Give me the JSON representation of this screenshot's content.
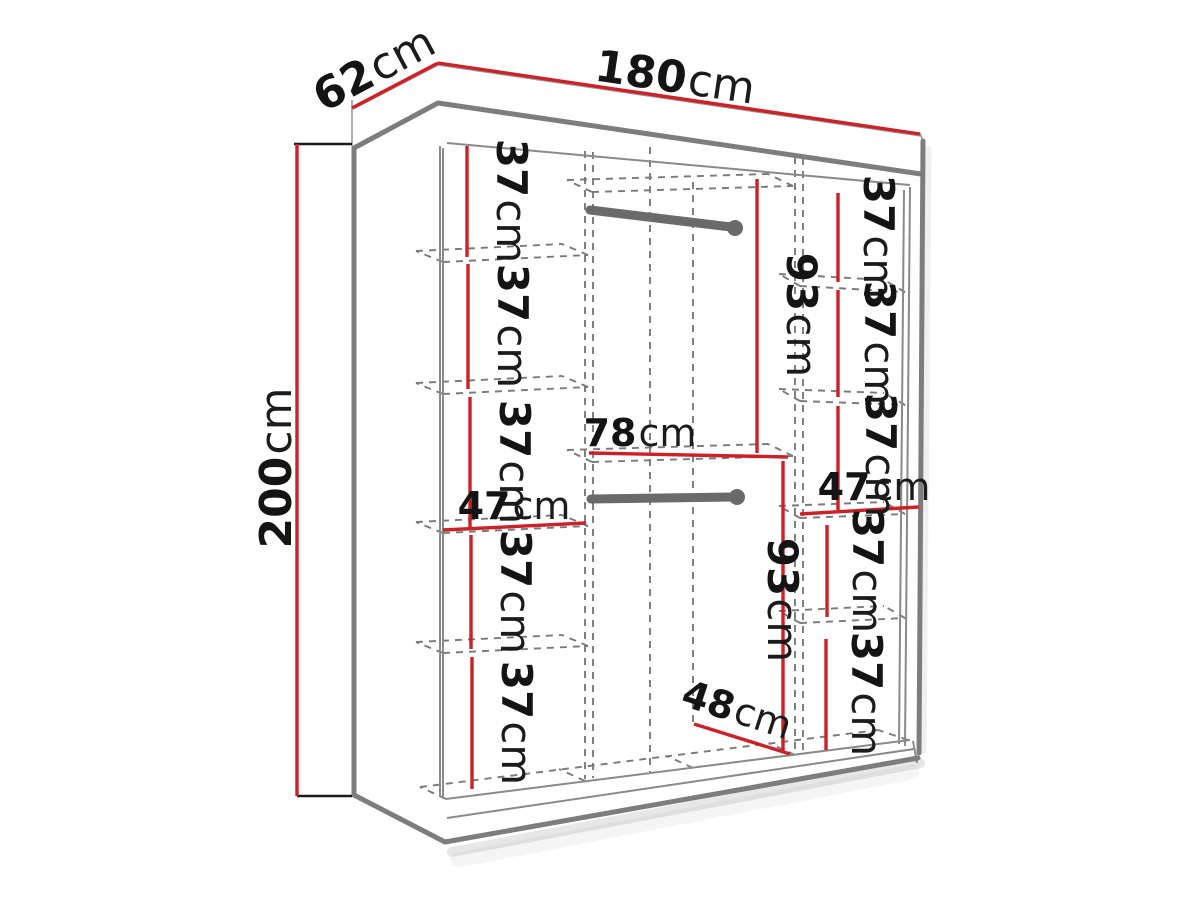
{
  "diagram": {
    "type": "furniture-dimension-diagram",
    "subject": "sliding-door wardrobe with interior shelf and rail dimensions",
    "colors": {
      "dimension_red": "#cc2127",
      "outline_gray": "#7d7d7d",
      "dashed_gray": "#7a7a7a",
      "rail_gray": "#6a6a6a",
      "text_black": "#141414"
    },
    "overall": {
      "width": {
        "num": "180",
        "unit": "cm"
      },
      "depth": {
        "num": "62",
        "unit": "cm"
      },
      "height": {
        "num": "200",
        "unit": "cm"
      }
    },
    "left_column": {
      "shelf_gaps": [
        {
          "num": "37",
          "unit": "cm"
        },
        {
          "num": "37",
          "unit": "cm"
        },
        {
          "num": "37",
          "unit": "cm"
        },
        {
          "num": "37",
          "unit": "cm"
        },
        {
          "num": "37",
          "unit": "cm"
        }
      ],
      "width": {
        "num": "47",
        "unit": "cm"
      }
    },
    "middle_column": {
      "upper_hanging_height": {
        "num": "93",
        "unit": "cm"
      },
      "width": {
        "num": "78",
        "unit": "cm"
      },
      "lower_hanging_height": {
        "num": "93",
        "unit": "cm"
      },
      "lower_width": {
        "num": "48",
        "unit": "cm"
      }
    },
    "right_column": {
      "upper_shelf_gaps": [
        {
          "num": "37",
          "unit": "cm"
        },
        {
          "num": "37",
          "unit": "cm"
        },
        {
          "num": "37",
          "unit": "cm"
        }
      ],
      "width": {
        "num": "47",
        "unit": "cm"
      },
      "lower_shelf_gaps": [
        {
          "num": "37",
          "unit": "cm"
        },
        {
          "num": "37",
          "unit": "cm"
        }
      ]
    }
  }
}
